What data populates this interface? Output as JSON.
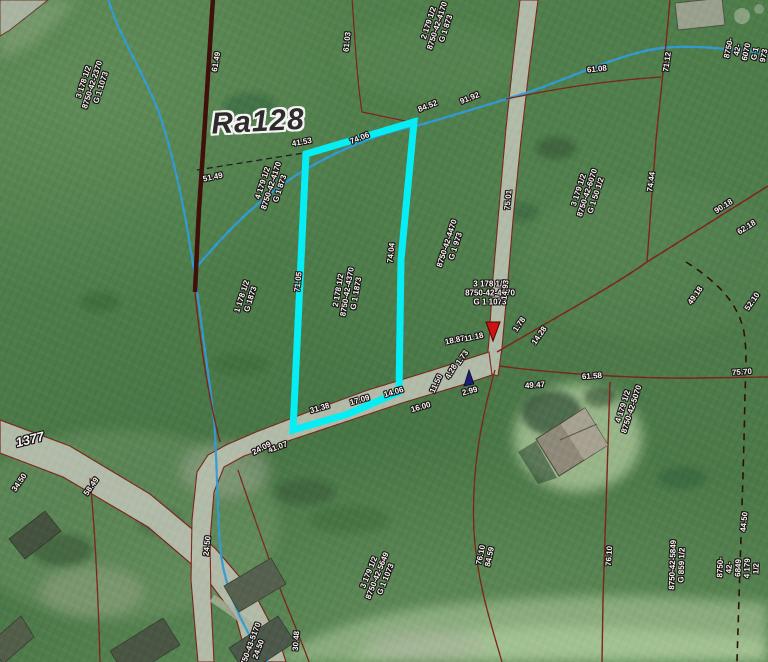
{
  "map": {
    "colors": {
      "highlight_parcel": "#06eef5",
      "parcel_boundary": "#7e241a",
      "thick_boundary": "#41100a",
      "stream": "#2f9cd8",
      "road_fill": "#b5bdac",
      "label_text": "#fff2f0",
      "label_halo": "#161616",
      "marker_red": "#cf1111",
      "marker_navy": "#1d1d72",
      "base_green": "#4d7c4a"
    },
    "markers": [
      {
        "name": "red-arrow-marker",
        "x": 493,
        "y": 341,
        "direction": "down",
        "color": "#cf1111"
      },
      {
        "name": "navy-arrow-marker",
        "x": 469,
        "y": 385,
        "direction": "up",
        "color": "#1d1d72"
      }
    ],
    "labels": [
      {
        "name": "road-name-label",
        "cls": "title",
        "text": "Ra128",
        "x": 258,
        "y": 122,
        "rot": -3
      },
      {
        "name": "road-number-label",
        "cls": "road",
        "text": "1377",
        "x": 30,
        "y": 440,
        "rot": -14
      },
      {
        "name": "parcel-label",
        "cls": "parcel",
        "text": "3 178 1/2\n8750-42-2370\nG 1 1073",
        "x": 93,
        "y": 85,
        "rot": -72
      },
      {
        "name": "parcel-label",
        "cls": "parcel",
        "text": "2 179 1/2\n8750-42-4170\nG 1 873",
        "x": 438,
        "y": 26,
        "rot": -72
      },
      {
        "name": "parcel-label",
        "cls": "parcel",
        "text": "8750-42-6070\nG 1 973",
        "x": 747,
        "y": 52,
        "rot": -78
      },
      {
        "name": "parcel-label",
        "cls": "parcel",
        "text": "4 179 1/2\n8750-42-4170\nG 1 873",
        "x": 272,
        "y": 186,
        "rot": -72
      },
      {
        "name": "parcel-label",
        "cls": "parcel",
        "text": "3 179 1/2\n8750-42-6070\nG 1 50 1/2",
        "x": 588,
        "y": 193,
        "rot": -72
      },
      {
        "name": "parcel-label",
        "cls": "parcel",
        "text": "1 178 1/2\nG 1873",
        "x": 247,
        "y": 298,
        "rot": -72
      },
      {
        "name": "parcel-label",
        "cls": "parcel",
        "text": "2 178 1/2\n8750-42-4370\nG 1 1873",
        "x": 348,
        "y": 292,
        "rot": -80
      },
      {
        "name": "parcel-label",
        "cls": "parcel",
        "text": "8750-42-4470\nG 1 973",
        "x": 452,
        "y": 245,
        "rot": -72
      },
      {
        "name": "parcel-label",
        "cls": "parcel",
        "text": "3 178 1/2\n8750-42-4370\nG 1 1073",
        "x": 490,
        "y": 294,
        "rot": 0
      },
      {
        "name": "parcel-label",
        "cls": "parcel",
        "text": "3 179 1/2\n8750-42-5649\nG 1 1073",
        "x": 378,
        "y": 576,
        "rot": -68
      },
      {
        "name": "parcel-label",
        "cls": "parcel",
        "text": "76.10\n84.59",
        "x": 486,
        "y": 556,
        "rot": -78
      },
      {
        "name": "parcel-label",
        "cls": "parcel",
        "text": "8750-42-5849\nG 859 1/2",
        "x": 678,
        "y": 565,
        "rot": -88
      },
      {
        "name": "parcel-label",
        "cls": "parcel",
        "text": "8750-42-6849\n4 179 1/2",
        "x": 739,
        "y": 568,
        "rot": -88
      },
      {
        "name": "parcel-label",
        "cls": "parcel",
        "text": "4 179 1/2\n8750-42-5070",
        "x": 628,
        "y": 408,
        "rot": -72
      },
      {
        "name": "parcel-label",
        "cls": "parcel",
        "text": "8750-43-5170\n24.50",
        "x": 255,
        "y": 648,
        "rot": -70
      },
      {
        "name": "edge-label",
        "cls": "edge",
        "text": "41.53",
        "x": 302,
        "y": 143,
        "rot": -10
      },
      {
        "name": "edge-label",
        "cls": "edge",
        "text": "74.06",
        "x": 360,
        "y": 139,
        "rot": -22
      },
      {
        "name": "edge-label",
        "cls": "edge",
        "text": "84.52",
        "x": 428,
        "y": 107,
        "rot": -22
      },
      {
        "name": "edge-label",
        "cls": "edge",
        "text": "91.92",
        "x": 470,
        "y": 99,
        "rot": -22
      },
      {
        "name": "edge-label",
        "cls": "edge",
        "text": "71.05",
        "x": 299,
        "y": 282,
        "rot": -84
      },
      {
        "name": "edge-label",
        "cls": "edge",
        "text": "74.04",
        "x": 392,
        "y": 253,
        "rot": -84
      },
      {
        "name": "edge-label",
        "cls": "edge",
        "text": "61.03",
        "x": 348,
        "y": 42,
        "rot": -84
      },
      {
        "name": "edge-label",
        "cls": "edge",
        "text": "61.49",
        "x": 217,
        "y": 62,
        "rot": -80
      },
      {
        "name": "edge-label",
        "cls": "edge",
        "text": "51.49",
        "x": 213,
        "y": 178,
        "rot": -12
      },
      {
        "name": "edge-label",
        "cls": "edge",
        "text": "61.08",
        "x": 597,
        "y": 70,
        "rot": -6
      },
      {
        "name": "edge-label",
        "cls": "edge",
        "text": "71.12",
        "x": 668,
        "y": 62,
        "rot": -82
      },
      {
        "name": "edge-label",
        "cls": "edge",
        "text": "74.44",
        "x": 652,
        "y": 182,
        "rot": -82
      },
      {
        "name": "edge-label",
        "cls": "edge",
        "text": "90.18",
        "x": 724,
        "y": 207,
        "rot": -32
      },
      {
        "name": "edge-label",
        "cls": "edge",
        "text": "62.18",
        "x": 747,
        "y": 228,
        "rot": -32
      },
      {
        "name": "edge-label",
        "cls": "edge",
        "text": "49.18",
        "x": 696,
        "y": 296,
        "rot": -55
      },
      {
        "name": "edge-label",
        "cls": "edge",
        "text": "52.10",
        "x": 753,
        "y": 302,
        "rot": -55
      },
      {
        "name": "edge-label",
        "cls": "edge",
        "text": "75.01",
        "x": 509,
        "y": 200,
        "rot": -84
      },
      {
        "name": "edge-label",
        "cls": "edge",
        "text": "14.93",
        "x": 506,
        "y": 290,
        "rot": -84
      },
      {
        "name": "edge-label",
        "cls": "edge",
        "text": "1.78",
        "x": 520,
        "y": 325,
        "rot": -55
      },
      {
        "name": "edge-label",
        "cls": "edge",
        "text": "14.28",
        "x": 540,
        "y": 336,
        "rot": -55
      },
      {
        "name": "edge-label",
        "cls": "edge",
        "text": "1.73",
        "x": 463,
        "y": 358,
        "rot": -55
      },
      {
        "name": "edge-label",
        "cls": "edge",
        "text": "18.87",
        "x": 455,
        "y": 341,
        "rot": -12
      },
      {
        "name": "edge-label",
        "cls": "edge",
        "text": "11.18",
        "x": 474,
        "y": 338,
        "rot": -12
      },
      {
        "name": "edge-label",
        "cls": "edge",
        "text": "11.50",
        "x": 437,
        "y": 384,
        "rot": -65
      },
      {
        "name": "edge-label",
        "cls": "edge",
        "text": "4.28",
        "x": 452,
        "y": 372,
        "rot": -60
      },
      {
        "name": "edge-label",
        "cls": "edge",
        "text": "2.99",
        "x": 470,
        "y": 392,
        "rot": -15
      },
      {
        "name": "edge-label",
        "cls": "edge",
        "text": "16.00",
        "x": 421,
        "y": 408,
        "rot": -16
      },
      {
        "name": "edge-label",
        "cls": "edge",
        "text": "14.06",
        "x": 394,
        "y": 393,
        "rot": -16
      },
      {
        "name": "edge-label",
        "cls": "edge",
        "text": "17.09",
        "x": 360,
        "y": 401,
        "rot": -16
      },
      {
        "name": "edge-label",
        "cls": "edge",
        "text": "31.38",
        "x": 320,
        "y": 409,
        "rot": -16
      },
      {
        "name": "edge-label",
        "cls": "edge",
        "text": "41.07",
        "x": 278,
        "y": 448,
        "rot": -20
      },
      {
        "name": "edge-label",
        "cls": "edge",
        "text": "24.09",
        "x": 262,
        "y": 449,
        "rot": -28
      },
      {
        "name": "edge-label",
        "cls": "edge",
        "text": "61.58",
        "x": 592,
        "y": 377,
        "rot": -4
      },
      {
        "name": "edge-label",
        "cls": "edge",
        "text": "49.47",
        "x": 535,
        "y": 386,
        "rot": -4
      },
      {
        "name": "edge-label",
        "cls": "edge",
        "text": "75.70",
        "x": 742,
        "y": 373,
        "rot": -4
      },
      {
        "name": "edge-label",
        "cls": "edge",
        "text": "76.10",
        "x": 610,
        "y": 556,
        "rot": -86
      },
      {
        "name": "edge-label",
        "cls": "edge",
        "text": "44.50",
        "x": 745,
        "y": 522,
        "rot": -84
      },
      {
        "name": "edge-label",
        "cls": "edge",
        "text": "24.50",
        "x": 208,
        "y": 546,
        "rot": -84
      },
      {
        "name": "edge-label",
        "cls": "edge",
        "text": "30.48",
        "x": 297,
        "y": 641,
        "rot": -86
      },
      {
        "name": "edge-label",
        "cls": "edge",
        "text": "58.49",
        "x": 92,
        "y": 487,
        "rot": -55
      },
      {
        "name": "edge-label",
        "cls": "edge",
        "text": "34.50",
        "x": 20,
        "y": 483,
        "rot": -55
      }
    ]
  }
}
